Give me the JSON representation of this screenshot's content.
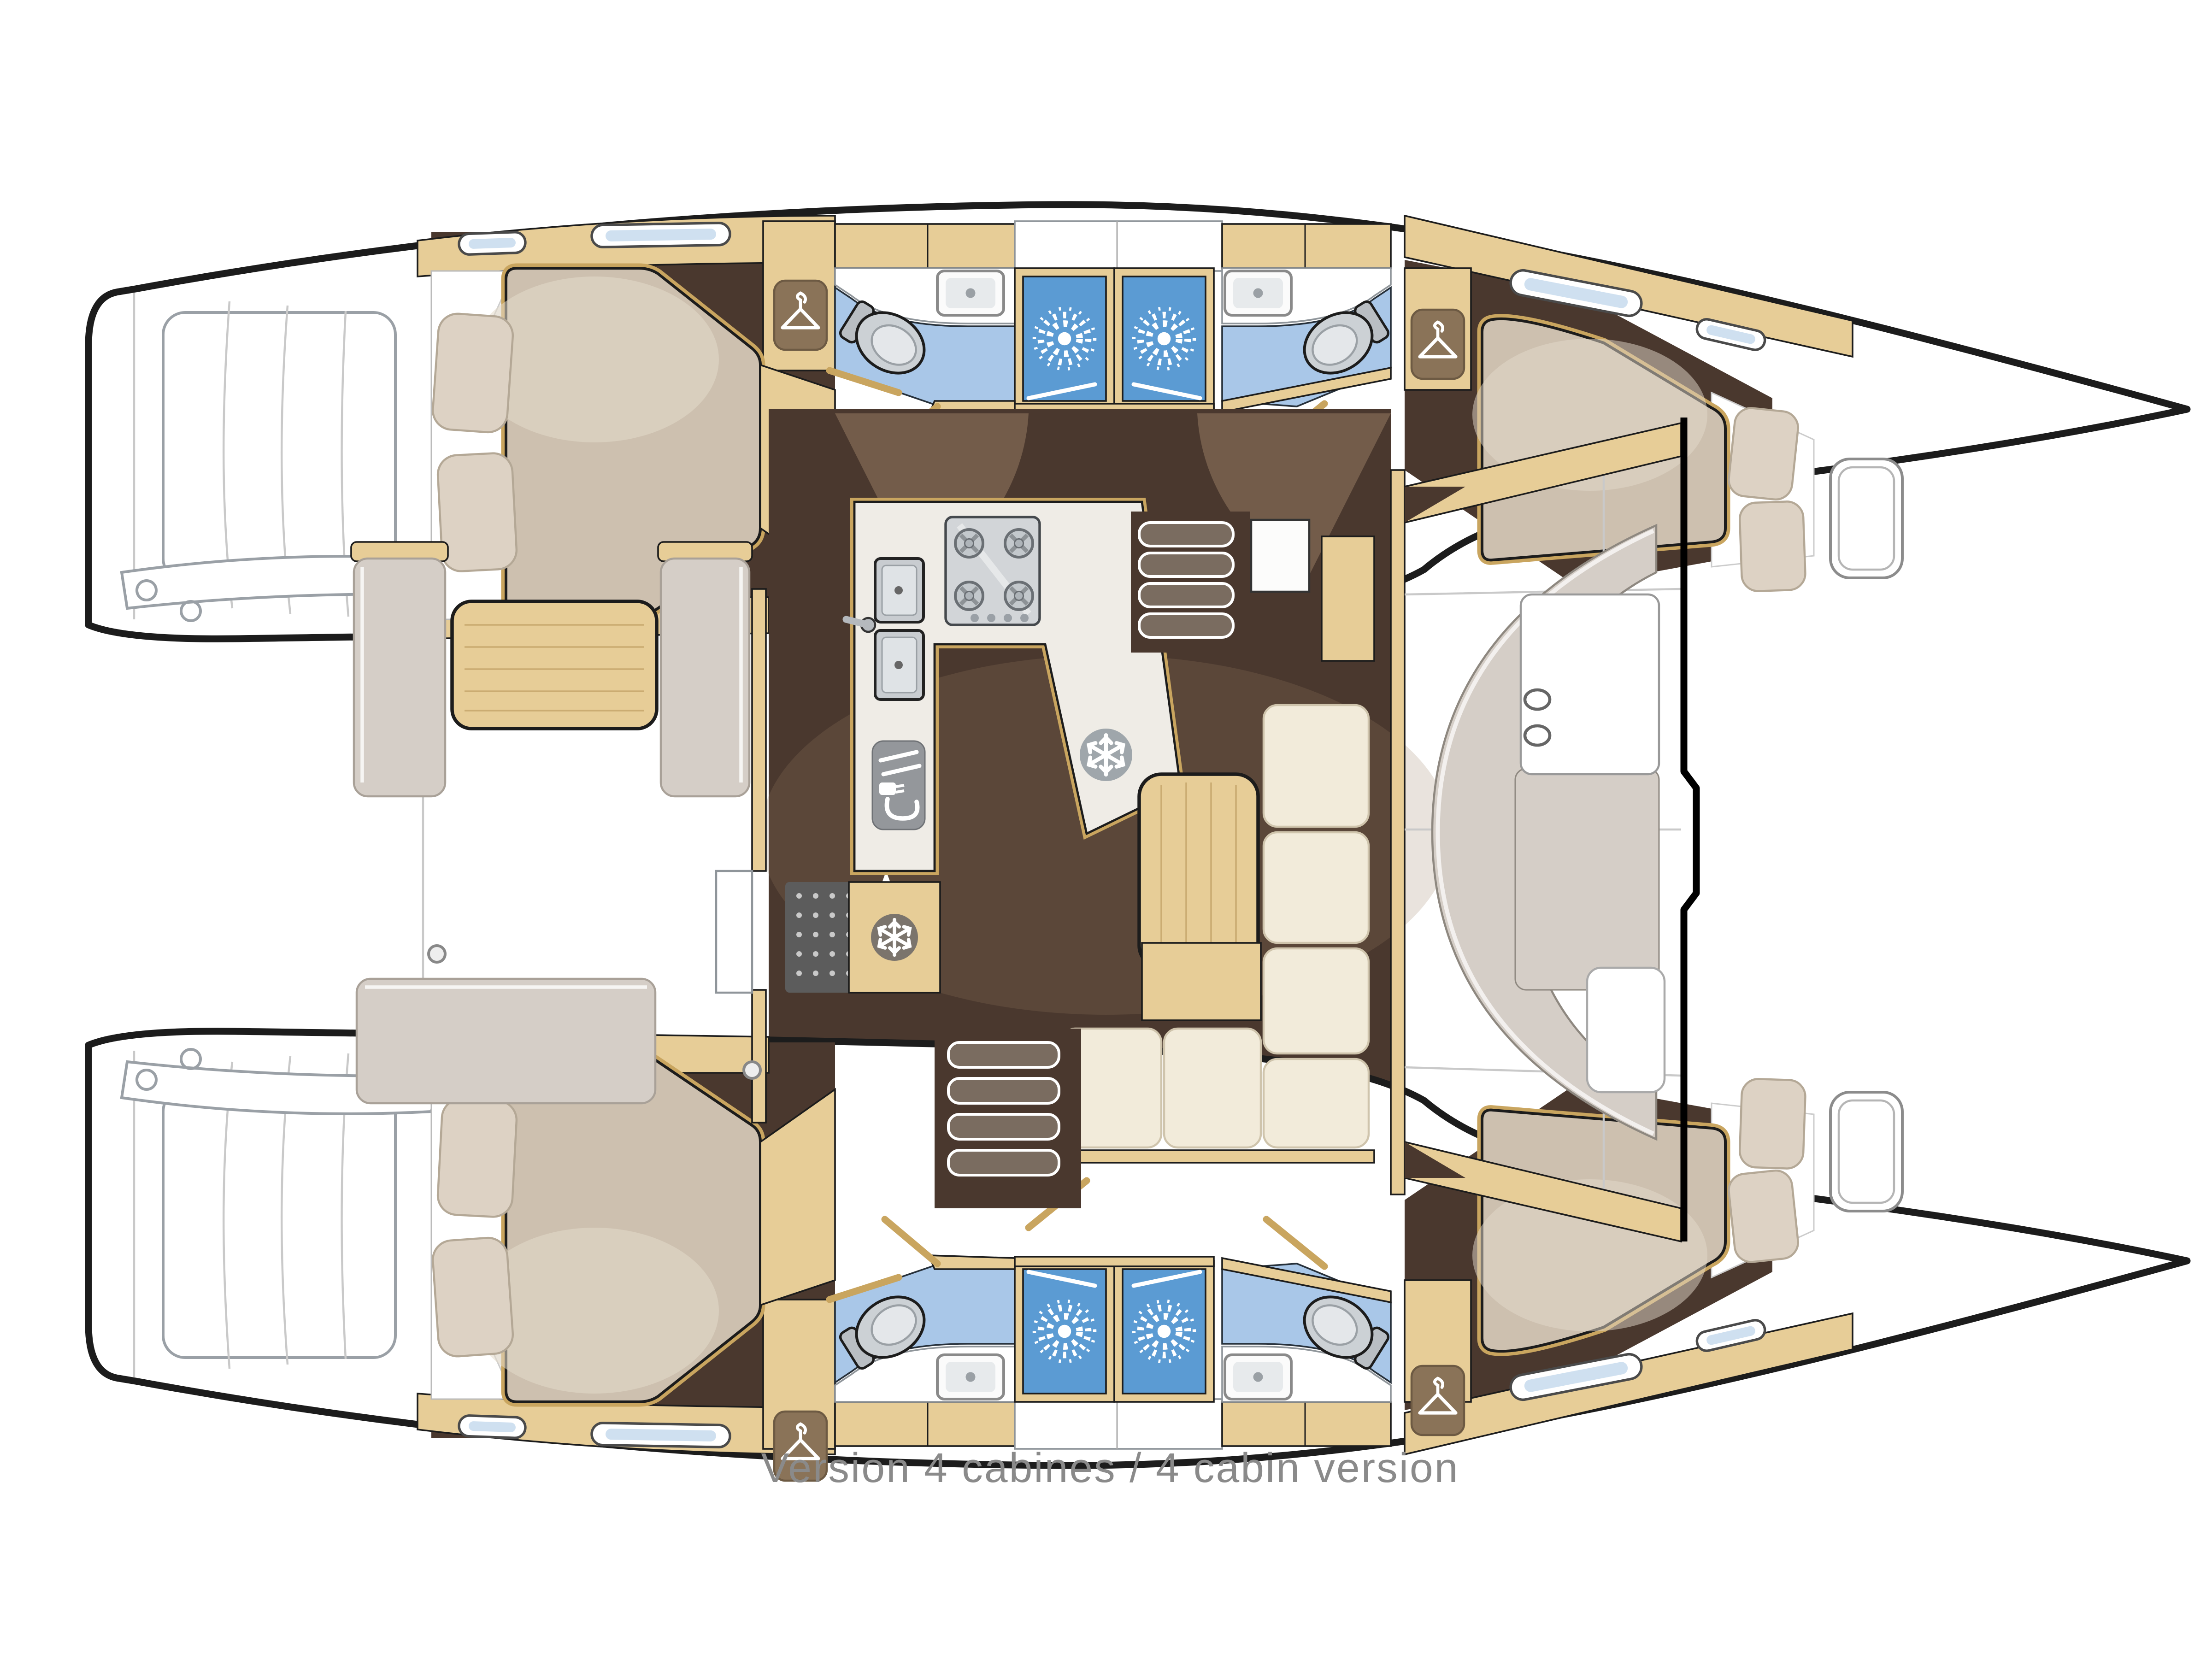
{
  "caption": {
    "text": "Version 4 cabines / 4 cabin version",
    "color": "#8a8a8a"
  },
  "colors": {
    "wood": "#e7cd97",
    "woodDeep": "#c9a55f",
    "woodDark": "#6d5a43",
    "wardrobe": "#8a7358",
    "floorDark": "#4a382e",
    "floorLight": "#9b8066",
    "blueLight": "#a9c7e8",
    "blueDeep": "#5b9bd3",
    "cream": "#f2ebda",
    "beige": "#cdc0af",
    "beigeLight": "#ddd2c4",
    "counter": "#efece6",
    "bench": "#d5cec7",
    "steel": "#c9cdd1",
    "ink": "#1c1c1c",
    "lineart": "#9aa0a6",
    "captionColor": "#8a8a8a"
  },
  "icons": {
    "hanger": "wardrobe hanger symbol",
    "shower": "sunburst shower-head symbol",
    "snowflake": "refrigerator / freezer symbol",
    "burner": "gas stove burner",
    "toilet": "marine toilet",
    "sink": "sink basin",
    "galley_appliance": "cutlery and power-plug symbol",
    "entry_arrow": "companionway entry arrow",
    "cupholder": "cockpit cup holder",
    "hatch": "deck hatch",
    "window": "hull portlight window"
  },
  "layout_counts": {
    "cabins": 4,
    "bathrooms": 4,
    "showers": 4,
    "fridges": 2,
    "hangers": 4
  }
}
